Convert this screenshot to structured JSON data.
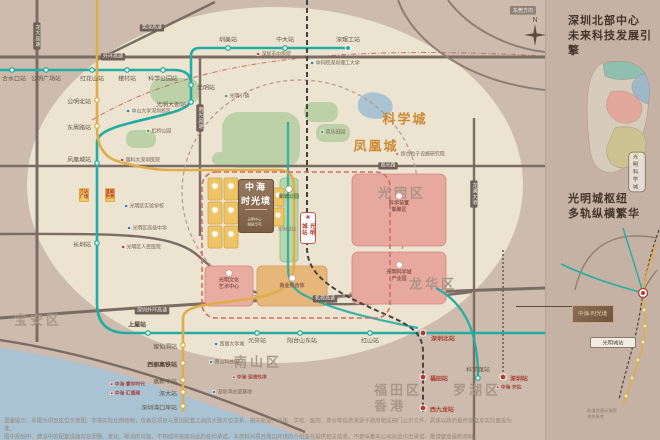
{
  "meta": {
    "direction_badge": "东莞方向",
    "compass": "N"
  },
  "project": {
    "name1": "中海",
    "name2": "时光境",
    "sub": "光明中心·瞰景华宅",
    "station_badge": "光明城站",
    "station_note": "光明城站"
  },
  "districts": [
    {
      "label": "光明区",
      "x": 402,
      "y": 192
    },
    {
      "label": "龙华区",
      "x": 433,
      "y": 283
    },
    {
      "label": "宝安区",
      "x": 38,
      "y": 319
    },
    {
      "label": "南山区",
      "x": 258,
      "y": 361
    },
    {
      "label": "福田区",
      "x": 398,
      "y": 389
    },
    {
      "label": "罗湖区",
      "x": 477,
      "y": 389
    },
    {
      "label": "香港",
      "x": 390,
      "y": 405
    }
  ],
  "areas": [
    {
      "label": "科学城",
      "x": 405,
      "y": 118
    },
    {
      "label": "凤凰城",
      "x": 376,
      "y": 145
    }
  ],
  "road_badges": [
    {
      "label": "外环高速",
      "x": 113,
      "y": 57,
      "v": false
    },
    {
      "label": "莞深高速",
      "x": 152,
      "y": 28,
      "v": false
    },
    {
      "label": "观光路",
      "x": 388,
      "y": 166,
      "v": false
    },
    {
      "label": "深圳外环高速",
      "x": 152,
      "y": 311,
      "v": false
    },
    {
      "label": "机荷高速",
      "x": 325,
      "y": 299,
      "v": false
    },
    {
      "label": "龙大高速",
      "x": 37,
      "y": 36,
      "v": true
    },
    {
      "label": "南光高速",
      "x": 200,
      "y": 118,
      "v": true
    },
    {
      "label": "龙澜大道",
      "x": 474,
      "y": 194,
      "v": true
    }
  ],
  "metro": {
    "line_colors": {
      "t": "#23ada2",
      "y": "#dfae49",
      "r": "#b03a30"
    },
    "stations": [
      {
        "n": "合水口站",
        "x": 12,
        "y": 70,
        "lx": 14,
        "ly": 79,
        "a": "m",
        "c": "t"
      },
      {
        "n": "公明广场站",
        "x": 46,
        "y": 70,
        "lx": 46,
        "ly": 79,
        "a": "m",
        "c": "t"
      },
      {
        "n": "红花山站",
        "x": 92,
        "y": 70,
        "lx": 92,
        "ly": 79,
        "a": "m",
        "c": "t"
      },
      {
        "n": "楼村站",
        "x": 127,
        "y": 70,
        "lx": 127,
        "ly": 79,
        "a": "m",
        "c": "t"
      },
      {
        "n": "科学公园站",
        "x": 163,
        "y": 70,
        "lx": 163,
        "ly": 79,
        "a": "m",
        "c": "t"
      },
      {
        "n": "光明站",
        "x": 191,
        "y": 85,
        "lx": 197,
        "ly": 88,
        "a": "s",
        "c": "t"
      },
      {
        "n": "光明大街站",
        "x": 191,
        "y": 102,
        "lx": 186,
        "ly": 105,
        "a": "e",
        "c": "t"
      },
      {
        "n": "圳美站",
        "x": 228,
        "y": 48,
        "lx": 228,
        "ly": 40,
        "a": "m",
        "c": "t"
      },
      {
        "n": "中大站",
        "x": 285,
        "y": 48,
        "lx": 285,
        "ly": 40,
        "a": "m",
        "c": "t"
      },
      {
        "n": "深理工站",
        "x": 348,
        "y": 48,
        "lx": 348,
        "ly": 40,
        "a": "m",
        "c": "t",
        "term": true
      },
      {
        "n": "凤凰城站",
        "x": 97,
        "y": 163,
        "lx": 91,
        "ly": 160,
        "a": "e",
        "c": "t"
      },
      {
        "n": "长圳站",
        "x": 97,
        "y": 243,
        "lx": 91,
        "ly": 245,
        "a": "e",
        "c": "t"
      },
      {
        "n": "上屋站",
        "x": 148,
        "y": 333,
        "lx": 146,
        "ly": 325,
        "a": "e",
        "c": "t",
        "b": 1
      },
      {
        "n": "元芬站",
        "x": 257,
        "y": 333,
        "lx": 257,
        "ly": 341,
        "a": "m",
        "c": "t"
      },
      {
        "n": "阳台山东站",
        "x": 300,
        "y": 333,
        "lx": 302,
        "ly": 341,
        "a": "m",
        "c": "t"
      },
      {
        "n": "红山站",
        "x": 370,
        "y": 333,
        "lx": 370,
        "ly": 341,
        "a": "m",
        "c": "t"
      },
      {
        "n": "深圳北站",
        "x": 423,
        "y": 333,
        "lx": 431,
        "ly": 339,
        "a": "s",
        "c": "r",
        "b": 1
      },
      {
        "n": "公明北站",
        "x": 97,
        "y": 100,
        "lx": 91,
        "ly": 102,
        "a": "e",
        "c": "y"
      },
      {
        "n": "东周路站",
        "x": 97,
        "y": 126,
        "lx": 91,
        "ly": 128,
        "a": "e",
        "c": "y"
      },
      {
        "n": "留仙洞站",
        "x": 183,
        "y": 345,
        "lx": 177,
        "ly": 347,
        "a": "e",
        "c": "y"
      },
      {
        "n": "西丽高铁站",
        "x": 183,
        "y": 363,
        "lx": 177,
        "ly": 365,
        "a": "e",
        "c": "y",
        "b": 1
      },
      {
        "n": "高新中站",
        "x": 183,
        "y": 380,
        "lx": 177,
        "ly": 382,
        "a": "e",
        "c": "y"
      },
      {
        "n": "深大站",
        "x": 183,
        "y": 392,
        "lx": 177,
        "ly": 394,
        "a": "e",
        "c": "y"
      },
      {
        "n": "深圳湾口岸站",
        "x": 183,
        "y": 406,
        "lx": 177,
        "ly": 408,
        "a": "e",
        "c": "y"
      },
      {
        "n": "福田站",
        "x": 423,
        "y": 377,
        "lx": 430,
        "ly": 379,
        "a": "s",
        "c": "r"
      },
      {
        "n": "西九龙站",
        "x": 423,
        "y": 408,
        "lx": 430,
        "ly": 410,
        "a": "s",
        "c": "r"
      },
      {
        "n": "科学馆站",
        "x": 478,
        "y": 378,
        "lx": 478,
        "ly": 370,
        "a": "m",
        "c": "t"
      },
      {
        "n": "深圳站",
        "x": 503,
        "y": 377,
        "lx": 510,
        "ly": 379,
        "a": "s",
        "c": "r"
      }
    ]
  },
  "landmarks": [
    {
      "label": "深圳市中医院",
      "x": 256,
      "y": 54,
      "icon": "hospital"
    },
    {
      "label": "中科院深圳理工大学",
      "x": 310,
      "y": 63,
      "icon": "school"
    },
    {
      "label": "中山大学深圳校区",
      "x": 126,
      "y": 111,
      "icon": "school"
    },
    {
      "label": "虹桥公园",
      "x": 146,
      "y": 131,
      "icon": "park"
    },
    {
      "label": "光明小镇",
      "x": 224,
      "y": 96,
      "icon": "park"
    },
    {
      "label": "欢乐田园",
      "x": 320,
      "y": 132,
      "icon": "park"
    },
    {
      "label": "综合粒子设施研究院",
      "x": 395,
      "y": 154,
      "icon": "sci"
    },
    {
      "label": "国科大深圳医院",
      "x": 120,
      "y": 160,
      "icon": "hospital"
    },
    {
      "label": "光明区实验学校",
      "x": 124,
      "y": 206,
      "icon": "school"
    },
    {
      "label": "光明区高级中学",
      "x": 127,
      "y": 228,
      "icon": "school"
    },
    {
      "label": "光明区人民医院",
      "x": 121,
      "y": 247,
      "icon": "hospital"
    },
    {
      "label": "西丽大学城",
      "x": 214,
      "y": 344,
      "icon": "school"
    },
    {
      "label": "南山科技园",
      "x": 209,
      "y": 362,
      "icon": "school"
    },
    {
      "label": "深圳湾总部基地",
      "x": 212,
      "y": 392,
      "icon": "school"
    }
  ],
  "malls": [
    {
      "l1": "万达",
      "l2": "广场",
      "x": 84,
      "y": 184
    },
    {
      "l1": "蓝鲸",
      "l2": "世界",
      "x": 110,
      "y": 184
    }
  ],
  "blocks": [
    {
      "lines": [
        "科学装置",
        "集聚区"
      ],
      "x": 399,
      "y": 203,
      "small": false
    },
    {
      "lines": [
        "光明科学城",
        "产业园"
      ],
      "x": 399,
      "y": 272,
      "small": false
    },
    {
      "lines": [
        "光明文化",
        "艺术中心"
      ],
      "x": 229,
      "y": 280,
      "small": false
    },
    {
      "lines": [
        "商业综合体"
      ],
      "x": 292,
      "y": 282,
      "small": false
    },
    {
      "lines": [
        "新城公园"
      ],
      "x": 289,
      "y": 193,
      "small": true
    }
  ],
  "legend_projects": [
    {
      "label": "中海·寰宇时代",
      "x": 110,
      "y": 384
    },
    {
      "label": "中海·汇德理",
      "x": 110,
      "y": 393
    },
    {
      "label": "中海·深湾玖序",
      "x": 232,
      "y": 377
    },
    {
      "label": "中海·天钻",
      "x": 496,
      "y": 387
    }
  ],
  "panel": {
    "s1": {
      "t1": "深圳北部中心",
      "t2": "未来科技发展引擎",
      "zones": [
        {
          "label": "生态活力环",
          "x": 613,
          "y": 76
        },
        {
          "label": "科教融合区",
          "x": 620,
          "y": 86
        },
        {
          "label": "光明中心区",
          "x": 629,
          "y": 103
        },
        {
          "label": "产业转化区",
          "x": 635,
          "y": 142
        }
      ],
      "notes": [
        {
          "lines": "大科学装置集聚布局 创新资源汇聚",
          "x": 571,
          "y": 86
        },
        {
          "lines": "以大科学装置群为核心 建设具有全球影响力的 科学城产业高地",
          "x": 571,
          "y": 112
        }
      ],
      "badge": "光明科学城"
    },
    "s2": {
      "t1": "光明城枢纽",
      "t2": "多轨纵横繁华",
      "logo": "中海·时光境",
      "hub_badge": "光明城站",
      "tags": [
        {
          "label": "赣深高铁",
          "x": 586,
          "y": 236
        },
        {
          "label": "6号线",
          "x": 564,
          "y": 258
        },
        {
          "label": "东莞南站",
          "x": 610,
          "y": 248
        }
      ],
      "stations": [
        {
          "label": "深圳北站",
          "x": 640,
          "y": 310
        },
        {
          "label": "福田站",
          "x": 637,
          "y": 330
        },
        {
          "label": "香港西九龙",
          "x": 634,
          "y": 352
        }
      ],
      "caption": "轨道交通示意图 仅供参考"
    }
  },
  "disclaimer": {
    "l1": "温馨提示：本图为项目区位示意图，非按实际比例绘制，仅表达项目与周边配套之间的大致方位关系，相关轨道、道路、学校、医院、商业等信息来源于政府相关部门公示文件，具体以政府最终批复及实际建设为准。",
    "l2": "图中规划中、建设中的配套设施存在调整、变化、取消的可能，不构成开发商对此的任何承诺。本资料对项目周边环境的介绍旨在提供相关信息，不意味着本公司对此作出承诺，敬请留意最新资料。"
  }
}
